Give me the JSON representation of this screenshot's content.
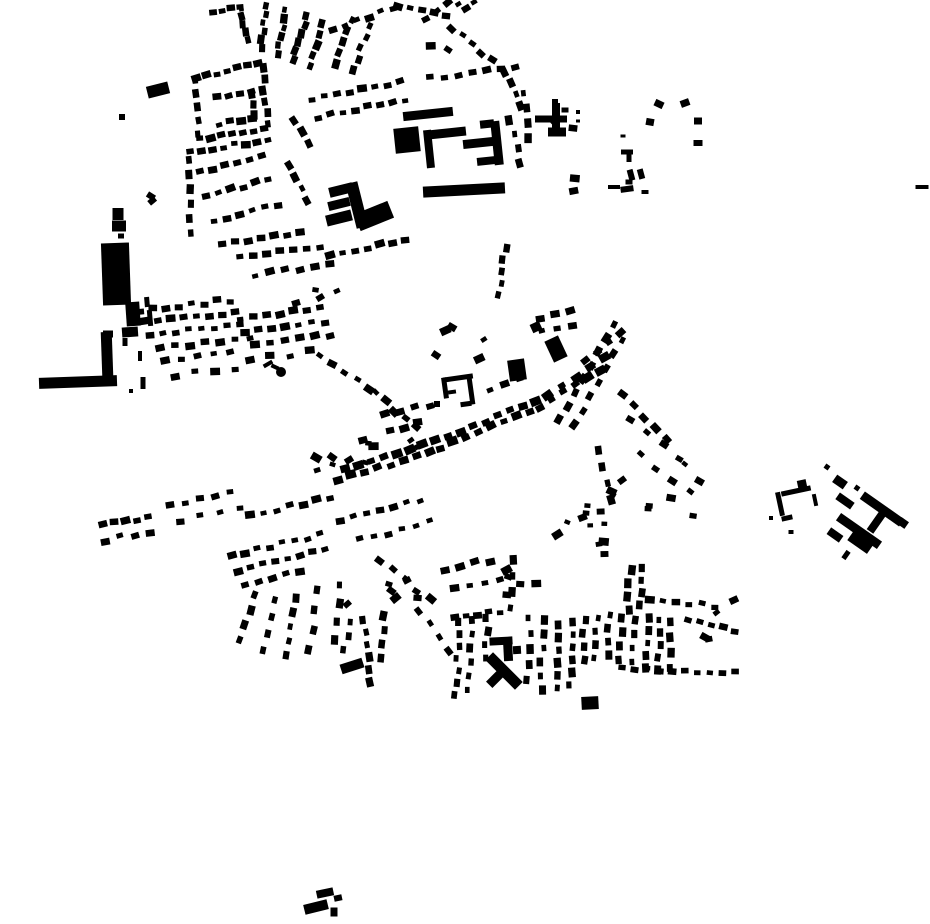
{
  "canvas": {
    "width": 930,
    "height": 924,
    "background": "#ffffff",
    "ink": "#000000"
  },
  "seed": 42,
  "defaults": {
    "house_w": 8,
    "house_h": 6,
    "perp_jitter": 2,
    "rot_jitter": 14,
    "size_jitter": 0.5
  },
  "landmarks": [
    [
      158,
      90,
      22,
      12,
      -14
    ],
    [
      122,
      117,
      6,
      6,
      0
    ],
    [
      118,
      214,
      11,
      12,
      0
    ],
    [
      119,
      226,
      14,
      11,
      0
    ],
    [
      121,
      236,
      6,
      5,
      0
    ],
    [
      116,
      274,
      28,
      62,
      -2
    ],
    [
      133,
      314,
      14,
      24,
      -4
    ],
    [
      130,
      332,
      16,
      10,
      -4
    ],
    [
      108,
      334,
      10,
      7,
      0
    ],
    [
      107,
      354,
      11,
      44,
      -2
    ],
    [
      78,
      382,
      78,
      11,
      -2
    ],
    [
      125,
      342,
      5,
      8,
      0
    ],
    [
      140,
      356,
      4,
      10,
      0
    ],
    [
      143,
      383,
      5,
      12,
      0
    ],
    [
      131,
      391,
      4,
      4,
      0
    ],
    [
      428,
      114,
      50,
      9,
      -6
    ],
    [
      407,
      140,
      25,
      25,
      -6
    ],
    [
      447,
      133,
      38,
      9,
      -6
    ],
    [
      429,
      149,
      8,
      38,
      -6
    ],
    [
      478,
      143,
      30,
      9,
      -6
    ],
    [
      497,
      143,
      9,
      44,
      -6
    ],
    [
      487,
      124,
      14,
      8,
      -6
    ],
    [
      486,
      161,
      18,
      8,
      -6
    ],
    [
      464,
      190,
      82,
      11,
      -3
    ],
    [
      357,
      205,
      12,
      46,
      -14
    ],
    [
      341,
      190,
      24,
      10,
      -14
    ],
    [
      339,
      204,
      22,
      9,
      -14
    ],
    [
      339,
      218,
      26,
      11,
      -14
    ],
    [
      374,
      216,
      36,
      18,
      -22
    ],
    [
      551,
      119,
      32,
      7,
      0
    ],
    [
      556,
      116,
      8,
      26,
      0
    ],
    [
      557,
      132,
      18,
      9,
      0
    ],
    [
      555,
      102,
      6,
      6,
      0
    ],
    [
      565,
      110,
      7,
      5,
      0
    ],
    [
      578,
      112,
      4,
      4,
      0
    ],
    [
      578,
      121,
      4,
      3,
      0
    ],
    [
      517,
      370,
      17,
      21,
      -8
    ],
    [
      458,
      378,
      30,
      5,
      -8
    ],
    [
      471,
      391,
      5,
      27,
      -8
    ],
    [
      445,
      388,
      5,
      21,
      -8
    ],
    [
      466,
      404,
      11,
      5,
      -8
    ],
    [
      452,
      392,
      8,
      4,
      -8
    ],
    [
      437,
      404,
      6,
      6,
      0
    ],
    [
      556,
      349,
      15,
      23,
      -25
    ],
    [
      536,
      327,
      10,
      9,
      -25
    ],
    [
      501,
      641,
      23,
      8,
      -3
    ],
    [
      508,
      650,
      9,
      22,
      -3
    ],
    [
      517,
      650,
      8,
      8,
      -3
    ],
    [
      504,
      671,
      42,
      11,
      45
    ],
    [
      497,
      677,
      22,
      9,
      -45
    ],
    [
      590,
      703,
      17,
      13,
      -3
    ],
    [
      352,
      666,
      23,
      10,
      -18
    ],
    [
      325,
      893,
      17,
      8,
      -12
    ],
    [
      338,
      898,
      8,
      6,
      -12
    ],
    [
      316,
      907,
      24,
      10,
      -14
    ],
    [
      334,
      912,
      7,
      9,
      0
    ],
    [
      840,
      482,
      13,
      9,
      35
    ],
    [
      845,
      501,
      18,
      8,
      35
    ],
    [
      859,
      531,
      50,
      9,
      35
    ],
    [
      882,
      509,
      48,
      9,
      35
    ],
    [
      878,
      520,
      8,
      28,
      35
    ],
    [
      862,
      540,
      24,
      17,
      35
    ],
    [
      835,
      535,
      15,
      8,
      35
    ],
    [
      846,
      555,
      5,
      9,
      35
    ],
    [
      903,
      523,
      9,
      8,
      35
    ],
    [
      857,
      488,
      5,
      5,
      35
    ],
    [
      827,
      467,
      5,
      5,
      35
    ],
    [
      796,
      491,
      30,
      5,
      -12
    ],
    [
      780,
      504,
      5,
      24,
      -12
    ],
    [
      787,
      518,
      11,
      5,
      -12
    ],
    [
      802,
      484,
      9,
      8,
      -12
    ],
    [
      815,
      500,
      4,
      12,
      -12
    ],
    [
      791,
      532,
      5,
      4,
      0
    ],
    [
      771,
      518,
      4,
      4,
      0
    ],
    [
      614,
      187,
      12,
      4,
      0
    ],
    [
      922,
      187,
      13,
      4,
      0
    ],
    [
      627,
      152,
      12,
      5,
      0
    ],
    [
      629,
      158,
      5,
      8,
      0
    ],
    [
      631,
      175,
      6,
      11,
      -15
    ],
    [
      641,
      174,
      6,
      10,
      -15
    ],
    [
      629,
      182,
      7,
      5,
      0
    ],
    [
      627,
      189,
      13,
      6,
      -8
    ],
    [
      645,
      192,
      7,
      4,
      0
    ],
    [
      623,
      136,
      5,
      3,
      0
    ],
    [
      659,
      104,
      9,
      7,
      25
    ],
    [
      685,
      103,
      9,
      7,
      -20
    ],
    [
      650,
      122,
      8,
      7,
      10
    ],
    [
      698,
      121,
      8,
      7,
      0
    ],
    [
      698,
      143,
      9,
      6,
      0
    ],
    [
      150,
      318,
      5,
      16,
      -5
    ],
    [
      147,
      302,
      5,
      10,
      -5
    ],
    [
      268,
      364,
      10,
      4,
      -30
    ],
    [
      275,
      367,
      8,
      4,
      25
    ]
  ],
  "streets": [
    [
      213,
      12,
      240,
      7,
      4
    ],
    [
      247,
      40,
      242,
      8,
      5
    ],
    [
      261,
      48,
      267,
      6,
      6
    ],
    [
      277,
      54,
      286,
      10,
      6
    ],
    [
      294,
      60,
      306,
      16,
      6
    ],
    [
      310,
      66,
      323,
      24,
      5
    ],
    [
      196,
      77,
      258,
      64,
      7
    ],
    [
      262,
      68,
      267,
      124,
      6
    ],
    [
      200,
      140,
      264,
      128,
      7
    ],
    [
      194,
      80,
      198,
      134,
      5
    ],
    [
      217,
      97,
      251,
      90,
      4
    ],
    [
      252,
      94,
      254,
      115,
      3
    ],
    [
      219,
      124,
      252,
      118,
      4
    ],
    [
      190,
      151,
      268,
      141,
      8
    ],
    [
      200,
      172,
      262,
      157,
      6
    ],
    [
      206,
      196,
      268,
      180,
      6
    ],
    [
      214,
      221,
      278,
      205,
      6
    ],
    [
      187,
      160,
      192,
      233,
      6
    ],
    [
      222,
      243,
      300,
      232,
      7
    ],
    [
      295,
      120,
      308,
      144,
      3
    ],
    [
      290,
      165,
      308,
      200,
      4
    ],
    [
      333,
      30,
      393,
      8,
      6
    ],
    [
      398,
      6,
      446,
      16,
      5
    ],
    [
      452,
      28,
      492,
      60,
      5
    ],
    [
      505,
      72,
      520,
      106,
      4
    ],
    [
      336,
      64,
      352,
      20,
      5
    ],
    [
      353,
      70,
      370,
      26,
      5
    ],
    [
      312,
      100,
      400,
      82,
      8
    ],
    [
      318,
      117,
      405,
      100,
      8
    ],
    [
      430,
      78,
      515,
      66,
      7
    ],
    [
      525,
      93,
      530,
      138,
      4
    ],
    [
      510,
      120,
      520,
      163,
      4
    ],
    [
      425,
      18,
      448,
      3,
      3
    ],
    [
      240,
      258,
      320,
      247,
      7
    ],
    [
      330,
      255,
      405,
      240,
      7
    ],
    [
      255,
      275,
      330,
      265,
      6
    ],
    [
      505,
      248,
      499,
      295,
      5
    ],
    [
      140,
      310,
      230,
      300,
      8
    ],
    [
      145,
      322,
      235,
      312,
      8
    ],
    [
      150,
      335,
      240,
      325,
      8
    ],
    [
      160,
      348,
      250,
      338,
      7
    ],
    [
      240,
      318,
      320,
      308,
      7
    ],
    [
      245,
      332,
      325,
      322,
      7
    ],
    [
      255,
      345,
      330,
      335,
      6
    ],
    [
      165,
      360,
      230,
      352,
      5
    ],
    [
      175,
      375,
      235,
      368,
      4
    ],
    [
      250,
      360,
      310,
      352,
      4
    ],
    [
      320,
      355,
      370,
      388,
      5
    ],
    [
      375,
      393,
      415,
      428,
      5
    ],
    [
      338,
      480,
      430,
      452,
      8,
      9,
      7
    ],
    [
      345,
      468,
      435,
      440,
      8,
      9,
      7
    ],
    [
      440,
      448,
      530,
      412,
      8,
      9,
      7
    ],
    [
      448,
      436,
      535,
      400,
      8,
      9,
      7
    ],
    [
      540,
      408,
      600,
      370,
      6,
      9,
      7
    ],
    [
      548,
      396,
      605,
      358,
      5,
      9,
      7
    ],
    [
      585,
      360,
      620,
      332,
      4
    ],
    [
      560,
      420,
      615,
      325,
      8
    ],
    [
      575,
      425,
      622,
      340,
      7
    ],
    [
      385,
      415,
      430,
      405,
      4
    ],
    [
      390,
      430,
      418,
      424,
      3
    ],
    [
      490,
      390,
      520,
      380,
      3
    ],
    [
      540,
      318,
      570,
      310,
      3
    ],
    [
      542,
      332,
      572,
      324,
      3
    ],
    [
      622,
      395,
      668,
      438,
      5
    ],
    [
      630,
      420,
      680,
      458,
      4
    ],
    [
      640,
      455,
      690,
      492,
      4
    ],
    [
      600,
      450,
      610,
      500,
      4
    ],
    [
      232,
      555,
      320,
      535,
      8
    ],
    [
      238,
      570,
      325,
      550,
      8
    ],
    [
      245,
      585,
      300,
      572,
      5
    ],
    [
      255,
      595,
      240,
      640,
      4
    ],
    [
      275,
      600,
      262,
      650,
      4
    ],
    [
      295,
      598,
      285,
      655,
      5
    ],
    [
      318,
      590,
      310,
      650,
      4
    ],
    [
      340,
      585,
      335,
      640,
      4
    ],
    [
      250,
      515,
      330,
      498,
      7
    ],
    [
      340,
      520,
      420,
      500,
      7
    ],
    [
      360,
      540,
      430,
      522,
      6
    ],
    [
      380,
      560,
      430,
      600,
      5
    ],
    [
      420,
      610,
      450,
      650,
      4
    ],
    [
      103,
      525,
      148,
      517,
      5
    ],
    [
      105,
      540,
      150,
      532,
      4
    ],
    [
      170,
      505,
      230,
      492,
      5
    ],
    [
      180,
      520,
      240,
      508,
      4
    ],
    [
      460,
      622,
      456,
      695,
      7
    ],
    [
      472,
      620,
      469,
      690,
      6
    ],
    [
      487,
      618,
      485,
      658,
      4
    ],
    [
      530,
      618,
      528,
      680,
      5
    ],
    [
      543,
      620,
      541,
      690,
      6
    ],
    [
      455,
      618,
      500,
      612,
      5
    ],
    [
      445,
      570,
      490,
      560,
      4
    ],
    [
      455,
      590,
      500,
      580,
      4
    ],
    [
      515,
      560,
      512,
      608,
      4
    ],
    [
      560,
      625,
      558,
      688,
      6
    ],
    [
      572,
      622,
      570,
      685,
      6
    ],
    [
      585,
      620,
      583,
      660,
      4
    ],
    [
      597,
      618,
      595,
      658,
      4
    ],
    [
      610,
      615,
      608,
      655,
      4
    ],
    [
      622,
      618,
      620,
      660,
      4
    ],
    [
      634,
      620,
      632,
      662,
      4
    ],
    [
      648,
      618,
      646,
      668,
      5
    ],
    [
      660,
      620,
      658,
      670,
      5
    ],
    [
      672,
      622,
      670,
      668,
      4
    ],
    [
      688,
      620,
      735,
      630,
      5
    ],
    [
      622,
      668,
      735,
      673,
      10
    ],
    [
      650,
      598,
      715,
      606,
      6
    ],
    [
      630,
      570,
      628,
      610,
      4
    ],
    [
      642,
      568,
      640,
      605,
      4
    ],
    [
      363,
      620,
      371,
      682,
      6
    ],
    [
      385,
      616,
      380,
      658,
      4
    ],
    [
      350,
      622,
      345,
      650,
      3
    ]
  ],
  "scatter": [
    [
      345,
      430,
      80,
      45,
      7
    ],
    [
      310,
      440,
      35,
      40,
      4
    ],
    [
      425,
      318,
      60,
      45,
      5
    ],
    [
      295,
      288,
      45,
      22,
      4
    ],
    [
      545,
      90,
      30,
      40,
      2
    ],
    [
      555,
      500,
      50,
      55,
      9
    ],
    [
      600,
      480,
      30,
      50,
      5
    ],
    [
      640,
      460,
      60,
      60,
      6
    ],
    [
      700,
      600,
      35,
      40,
      4
    ],
    [
      505,
      555,
      45,
      45,
      5
    ],
    [
      330,
      560,
      90,
      45,
      6
    ],
    [
      145,
      195,
      25,
      28,
      2
    ],
    [
      455,
      0,
      30,
      18,
      3
    ],
    [
      573,
      178,
      20,
      15,
      2
    ],
    [
      425,
      45,
      25,
      20,
      2
    ]
  ],
  "dots": [
    [
      281,
      372,
      5
    ]
  ]
}
